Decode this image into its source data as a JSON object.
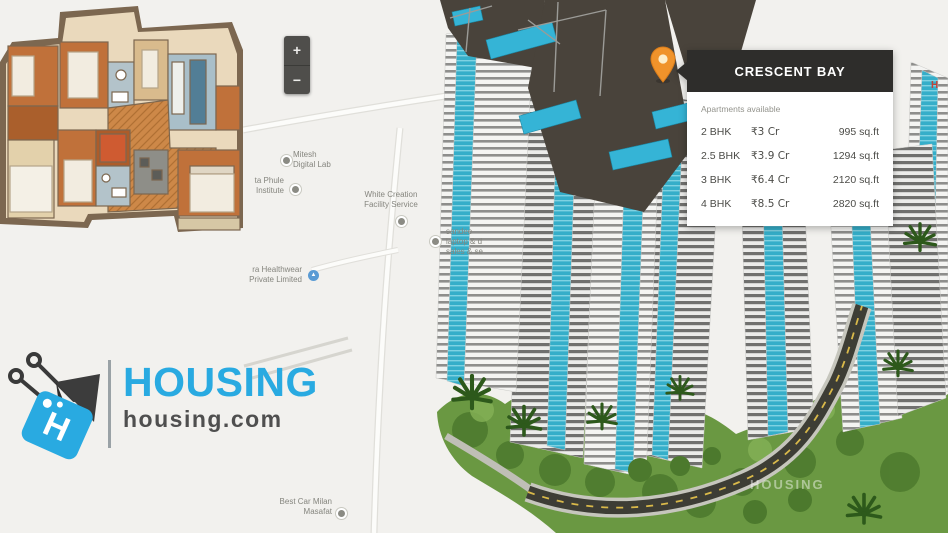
{
  "map": {
    "zoom_in_label": "+",
    "zoom_out_label": "−",
    "labels": {
      "digital_lab": "Mitesh\nDigital Lab",
      "phule_institute": "ta Phule\nInstitute",
      "white_creation": "White Creation\nFacility Service",
      "sandeep": "sandee\nlaptop & d\nsales & se",
      "healthwear": "ra Healthwear\nPrivate Limited",
      "best_car": "Best Car Milan\nMasafat"
    },
    "hospital_marker": "H",
    "watermark": "HOUSING"
  },
  "popup": {
    "title": "CRESCENT BAY",
    "subtitle": "Apartments available",
    "rows": [
      {
        "type": "2 BHK",
        "price": "₹3 Cr",
        "area": "995 sq.ft"
      },
      {
        "type": "2.5 BHK",
        "price": "₹3.9 Cr",
        "area": "1294 sq.ft"
      },
      {
        "type": "3 BHK",
        "price": "₹6.4 Cr",
        "area": "2120 sq.ft"
      },
      {
        "type": "4 BHK",
        "price": "₹8.5 Cr",
        "area": "2820 sq.ft"
      }
    ]
  },
  "logo": {
    "brand": "HOUSING",
    "domain": "housing.com",
    "tag_letter": "H"
  },
  "colors": {
    "brand_blue": "#29aae1",
    "popup_header": "#2e2d2b",
    "accent_teal": "#35b4d6",
    "pin_orange": "#f0932b",
    "map_bg": "#f2f1ee",
    "lawn_green": "#6a9842",
    "road_dark": "#3d3d35",
    "road_dash_yellow": "#d9b94a"
  }
}
